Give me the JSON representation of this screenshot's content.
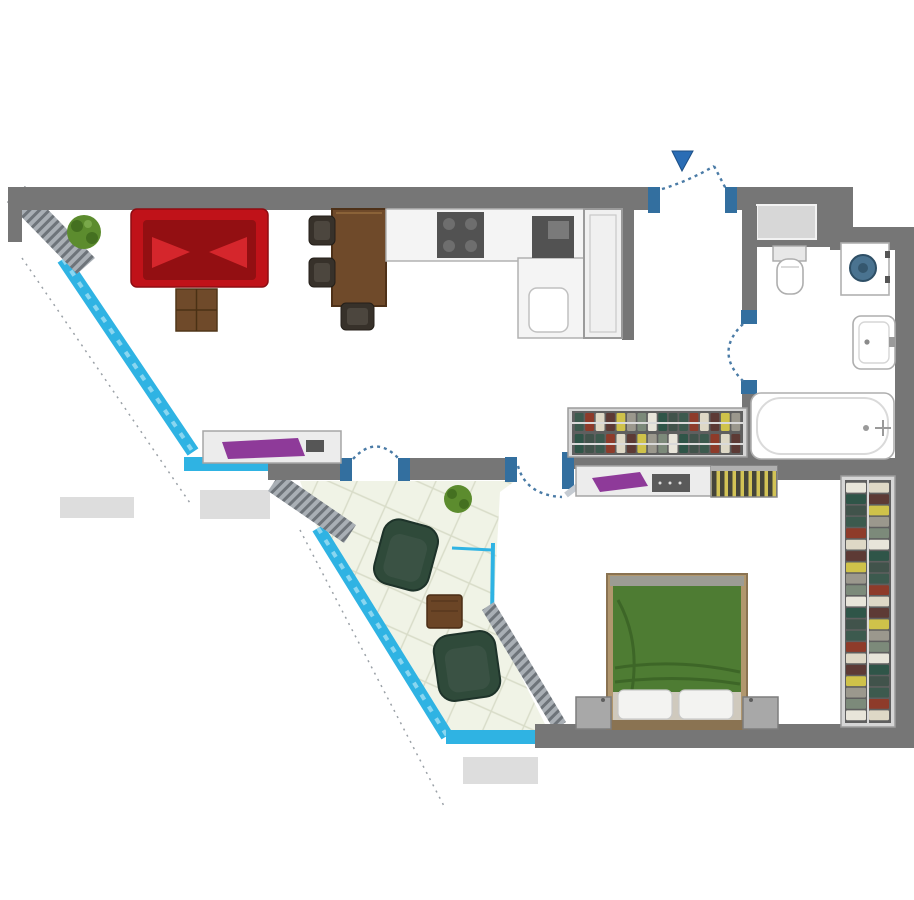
{
  "scene": {
    "type": "apartment-floor-plan",
    "canvas_width": 914,
    "canvas_height": 900,
    "background": "#ffffff"
  },
  "colors": {
    "wall": "#767676",
    "shaft": "#d7d7d7",
    "hatch_base": "#a9afb5",
    "hatch_line": "#6e747a",
    "glass": "#2fb3e3",
    "glass_light": "#a9e1f4",
    "jamb": "#336f9f",
    "arc": "#4a7ba6",
    "accent_arrow": "#2a6db5",
    "balcony_floor": "#f0f3e6",
    "tile_line": "#d8dcc8",
    "mat": "#dddddd",
    "counter": "#f4f4f4",
    "counter_edge": "#b2b2b2",
    "appliance_dark": "#525252",
    "appliance_mid": "#6f6f6f",
    "wood": "#6f4a2a",
    "wood_dark": "#4e3118",
    "chair_dark": "#37312a",
    "chair_inner": "#4c463e",
    "sofa": "#c01219",
    "sofa_dark": "#930f12",
    "sofa_cushion": "#d5262c",
    "plant": "#5c8c2e",
    "plant_dark": "#447020",
    "armchair": "#2f4a3a",
    "armchair_edge": "#1e criticalize332a",
    "armchair_seat": "#3a5244",
    "table_brown": "#6b4526",
    "bed_frame": "#b1976e",
    "bed_frame_edge": "#8a7352",
    "bed_green": "#4e7c33",
    "bed_green_dark": "#3a6024",
    "pillow": "#f3f3f1",
    "foot_strip": "#cfc9bd",
    "nightstand": "#a8a8a8",
    "nightstand_edge": "#7d7d7d",
    "wardrobe_frame": "#d6d6d6",
    "wardrobe_edge": "#9c9c9c",
    "wardrobe_bg": "#5f5f5f",
    "rail": "#d9d9d9",
    "radiator_dark": "#45453a",
    "radiator_yellow": "#d2c356",
    "fixture": "#ffffff",
    "fixture_edge": "#aeaeae",
    "fixture_inner": "#dcdcdc",
    "drum": "#4a7390",
    "drum_dark": "#2e4f66",
    "dresser_item_purple": "#8e3a99",
    "leaf": "#c5cbd2"
  },
  "wardrobe": {
    "palette": [
      "#3c5a4e",
      "#e8e5da",
      "#cfc24a",
      "#8e3b2a",
      "#2f5548",
      "#9b988d",
      "#ded8c6",
      "#41534b",
      "#7c8a7a",
      "#5d3a35"
    ],
    "hall_strip_count": 16,
    "bedroom_strip_count": 21
  },
  "objects": {
    "living_room": [
      "plant",
      "sofa",
      "coffee-table",
      "dining-table",
      "dining-chairs",
      "sideboard"
    ],
    "kitchen": [
      "counter",
      "stove",
      "sink-unit",
      "corner-counter",
      "corner-basin",
      "tall-cabinet"
    ],
    "entrance": [
      "door-swing",
      "entrance-arrow"
    ],
    "bathroom": [
      "duct-shaft",
      "toilet",
      "washing-machine",
      "washbasin",
      "bathtub",
      "door-swing"
    ],
    "hallway": [
      "wardrobe-with-clothes"
    ],
    "bedroom": [
      "dresser",
      "radiator",
      "double-bed",
      "pillows",
      "nightstands",
      "wardrobe-with-clothes",
      "door-swing"
    ],
    "balcony": [
      "tiled-floor",
      "plant",
      "armchair",
      "armchair",
      "side-table",
      "glass-walls"
    ]
  }
}
